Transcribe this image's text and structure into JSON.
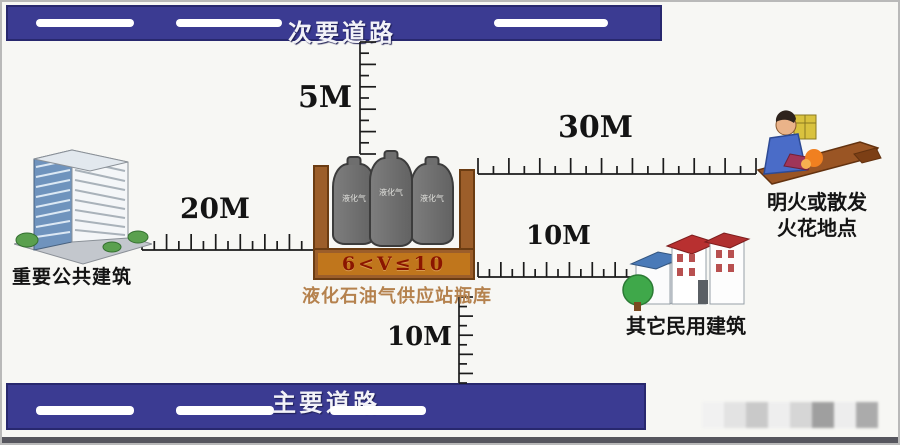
{
  "roads": {
    "secondary": {
      "label": "次要道路"
    },
    "main": {
      "label": "主要道路"
    }
  },
  "distances": {
    "to_secondary_road": "5M",
    "to_public_building": "20M",
    "to_open_flame": "30M",
    "to_civilian_building": "10M",
    "to_main_road": "10M"
  },
  "station": {
    "volume_label": "6<V≤10",
    "name": "液化石油气供应站瓶库",
    "cylinder_label": "液化气"
  },
  "landmarks": {
    "public_building": "重要公共建筑",
    "open_flame_line1": "明火或散发",
    "open_flame_line2": "火花地点",
    "civilian_building": "其它民用建筑"
  },
  "colors": {
    "road_blue": "#3b3b92",
    "container_brown": "#9c5e2a",
    "basin_orange": "#c0761c",
    "volume_text": "#8b1500",
    "station_text": "#b5824e"
  }
}
